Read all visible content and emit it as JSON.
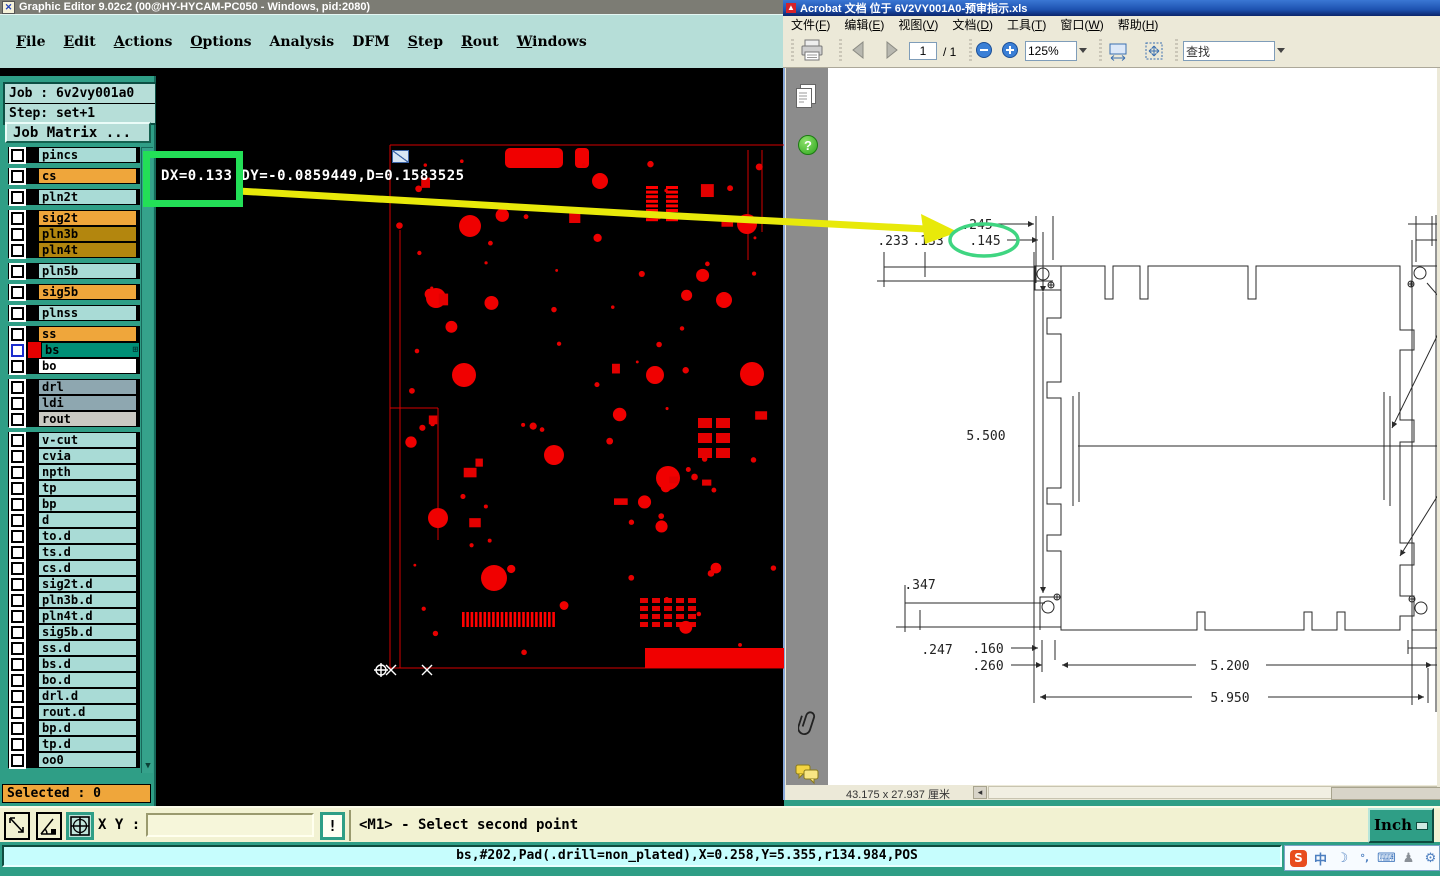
{
  "graphic_editor": {
    "title": "Graphic Editor 9.02c2 (00@HY-HYCAM-PC050 - Windows, pid:2080)",
    "menus": [
      {
        "label": "File",
        "u": 0
      },
      {
        "label": "Edit",
        "u": 0
      },
      {
        "label": "Actions",
        "u": 0
      },
      {
        "label": "Options",
        "u": 0
      },
      {
        "label": "Analysis",
        "u": -1
      },
      {
        "label": "DFM",
        "u": -1
      },
      {
        "label": "Step",
        "u": 0
      },
      {
        "label": "Rout",
        "u": 0
      },
      {
        "label": "Windows",
        "u": 0
      }
    ],
    "job_label": "Job : 6v2vy001a0",
    "step_label": "Step: set+1",
    "job_matrix_label": "Job Matrix ...",
    "layers": [
      {
        "name": "pincs",
        "bg": "#a9dbd6"
      },
      {
        "name": "cs",
        "bg": "#efa63b",
        "gap": true
      },
      {
        "name": "pln2t",
        "bg": "#a9dbd6",
        "gap": true
      },
      {
        "name": "sig2t",
        "bg": "#efa63b",
        "gap": true
      },
      {
        "name": "pln3b",
        "bg": "#b3860e"
      },
      {
        "name": "pln4t",
        "bg": "#b3860e"
      },
      {
        "name": "pln5b",
        "bg": "#a9dbd6",
        "gap": true
      },
      {
        "name": "sig5b",
        "bg": "#efa63b",
        "gap": true
      },
      {
        "name": "plnss",
        "bg": "#a9dbd6",
        "gap": true
      },
      {
        "name": "ss",
        "bg": "#efa63b",
        "gap": true
      },
      {
        "name": "bs",
        "bg": "#008f76",
        "selected": true
      },
      {
        "name": "bo",
        "bg": "#ffffff"
      },
      {
        "name": "drl",
        "bg": "#8ea7b0",
        "gap": true
      },
      {
        "name": "ldi",
        "bg": "#8ea7b0"
      },
      {
        "name": "rout",
        "bg": "#cac9c2"
      },
      {
        "name": "v-cut",
        "bg": "#a9dbd6",
        "gap": true
      },
      {
        "name": "cvia",
        "bg": "#a9dbd6"
      },
      {
        "name": "npth",
        "bg": "#a9dbd6"
      },
      {
        "name": "tp",
        "bg": "#a9dbd6"
      },
      {
        "name": "bp",
        "bg": "#a9dbd6"
      },
      {
        "name": "d",
        "bg": "#a9dbd6"
      },
      {
        "name": "to.d",
        "bg": "#a9dbd6"
      },
      {
        "name": "ts.d",
        "bg": "#a9dbd6"
      },
      {
        "name": "cs.d",
        "bg": "#a9dbd6"
      },
      {
        "name": "sig2t.d",
        "bg": "#a9dbd6"
      },
      {
        "name": "pln3b.d",
        "bg": "#a9dbd6"
      },
      {
        "name": "pln4t.d",
        "bg": "#a9dbd6"
      },
      {
        "name": "sig5b.d",
        "bg": "#a9dbd6"
      },
      {
        "name": "ss.d",
        "bg": "#a9dbd6"
      },
      {
        "name": "bs.d",
        "bg": "#a9dbd6"
      },
      {
        "name": "bo.d",
        "bg": "#a9dbd6"
      },
      {
        "name": "drl.d",
        "bg": "#a9dbd6"
      },
      {
        "name": "rout.d",
        "bg": "#a9dbd6"
      },
      {
        "name": "bp.d",
        "bg": "#a9dbd6"
      },
      {
        "name": "tp.d",
        "bg": "#a9dbd6"
      },
      {
        "name": "oo0",
        "bg": "#a9dbd6"
      }
    ],
    "selected_label": "Selected : 0",
    "canvas": {
      "measurement": "DX=0.133 DY=-0.0859449,D=0.1583525"
    },
    "bottom_toolbar": {
      "xy_label": "X Y :",
      "xy_value": "",
      "alert_label": "!",
      "prompt": "<M1> - Select second point",
      "units_label": "Inch",
      "button_icons": [
        "measure-distance-icon",
        "measure-angle-icon",
        "snap-grid-icon"
      ]
    },
    "status_line": "bs,#202,Pad(.drill=non_plated),X=0.258,Y=5.355,r134.984,POS"
  },
  "acrobat": {
    "title": "Acrobat 文档 位于 6V2VY001A0-预审指示.xls",
    "menus": [
      "文件(F)",
      "编辑(E)",
      "视图(V)",
      "文档(D)",
      "工具(T)",
      "窗口(W)",
      "帮助(H)"
    ],
    "toolbar": {
      "page_value": "1",
      "page_total": "/ 1",
      "zoom_value": "125%",
      "find_value": "查找"
    },
    "sidebar_icons": [
      "pages-icon",
      "help-icon",
      "paperclip-icon",
      "comments-icon"
    ],
    "drawing": {
      "dims": {
        "d245": ".245",
        "d233": ".233",
        "d133": ".133",
        "d145": ".145",
        "v5500": "5.500",
        "d347": ".347",
        "d247": ".247",
        "d160": ".160",
        "d260": ".260",
        "h5200": "5.200",
        "h5950": "5.950"
      }
    },
    "statusbar": {
      "page_size": "43.175 x 27.937 厘米"
    }
  },
  "taskbar": {
    "tray_icons": [
      {
        "name": "sogou-input-icon",
        "glyph": "S"
      },
      {
        "name": "chinese-mode-icon",
        "glyph": "中"
      },
      {
        "name": "moon-icon",
        "glyph": "☽"
      },
      {
        "name": "punctuation-icon",
        "glyph": "°,"
      },
      {
        "name": "keyboard-icon",
        "glyph": "⌨"
      },
      {
        "name": "person-icon",
        "glyph": "♟"
      },
      {
        "name": "wrench-icon",
        "glyph": "⚙"
      }
    ]
  },
  "annotations": {
    "highlight_box_color": "#23df57",
    "arrow_color": "#e8e90a",
    "ellipse_color": "#3fd581"
  }
}
